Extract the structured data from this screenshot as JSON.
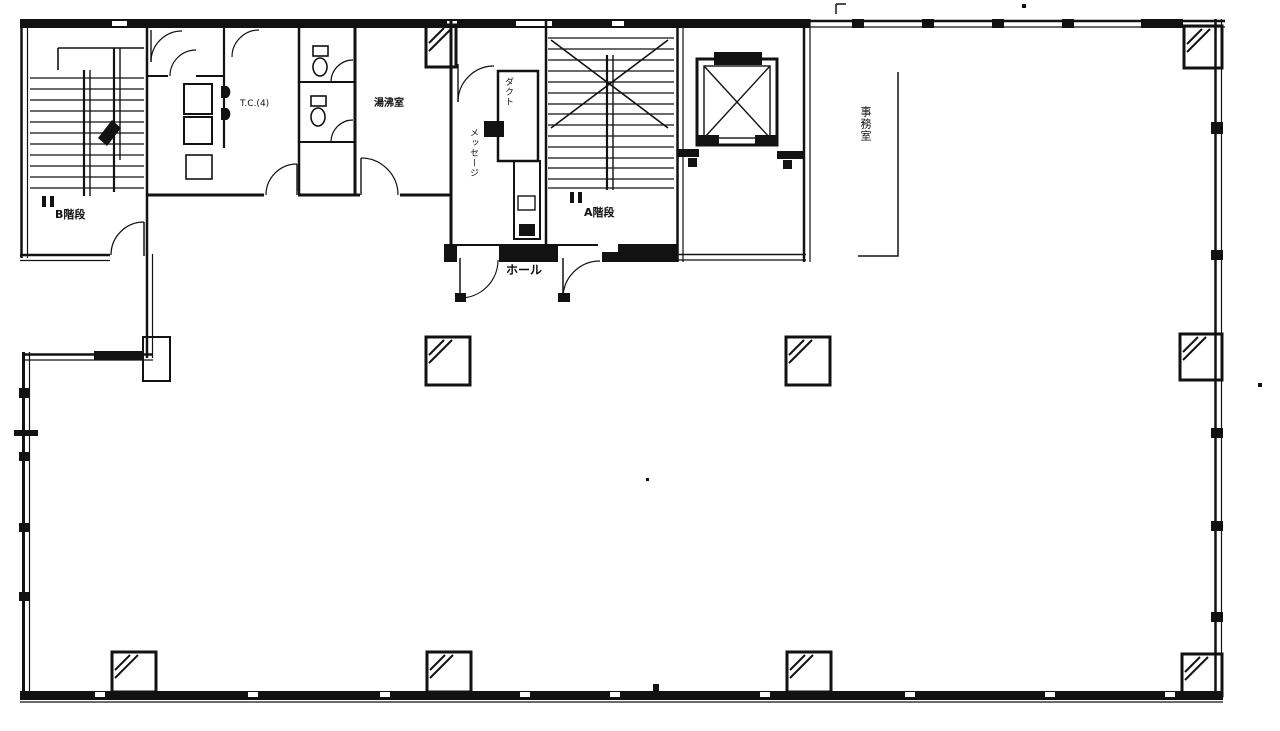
{
  "drawing": {
    "kind": "building-floor-plan",
    "colors": {
      "ink": "#121212",
      "paper": "#ffffff"
    }
  },
  "labels": {
    "stair_b": "B階段",
    "stair_a": "A階段",
    "toilet": "T.C.(4)",
    "kitchenette": "湯沸室",
    "duct_shaft": "ダクト",
    "passage": "メッセージ",
    "hall": "ホール",
    "office": "事務室"
  }
}
